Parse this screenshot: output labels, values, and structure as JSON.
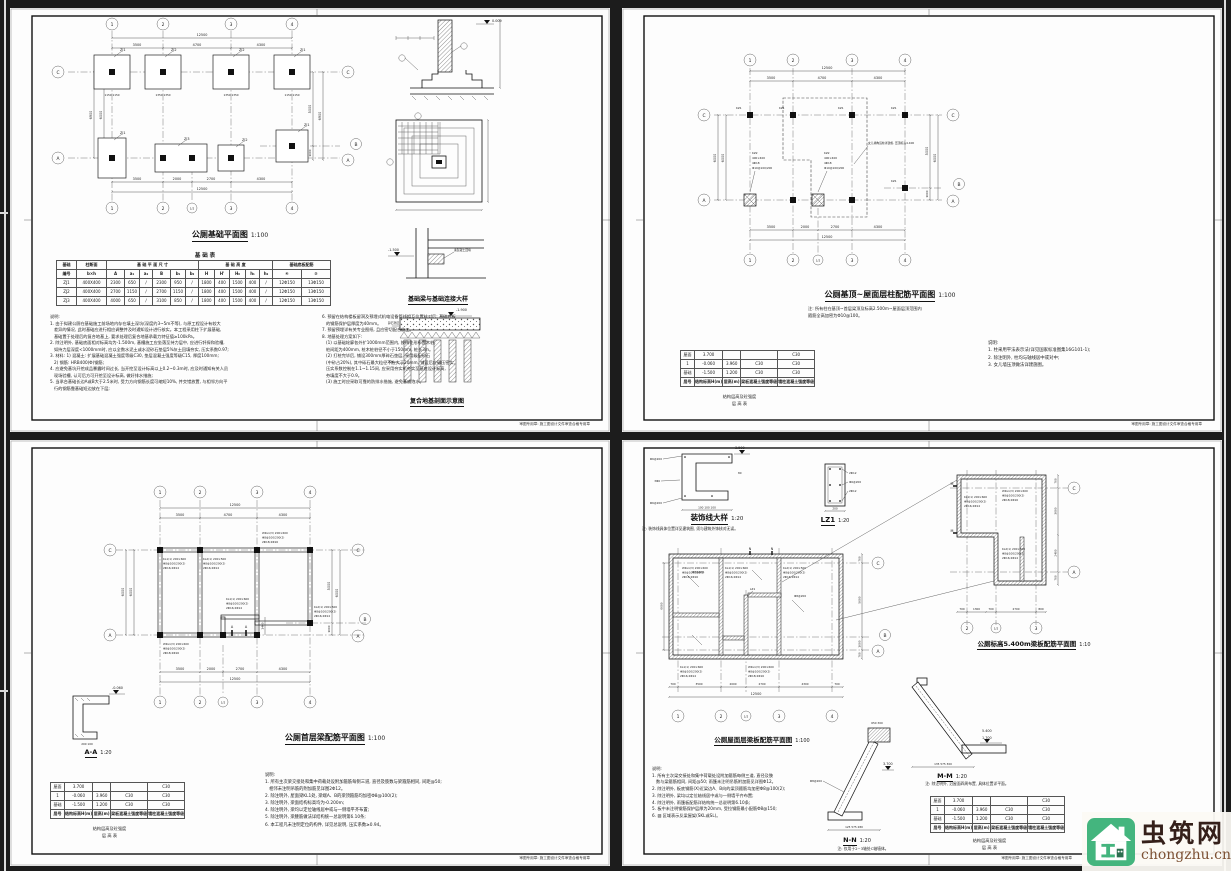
{
  "watermark": {
    "name": "虫筑网",
    "domain": "chongzhu.cn",
    "logo_green": "#44b57e",
    "logo_dark": "#2c6e4f",
    "name_color": "#35201a",
    "domain_color": "#7d5134"
  },
  "shared": {
    "footer": "审图专用章: 施工图设计文件审查合格专用章",
    "floor_table": {
      "col_widths": [
        14,
        24,
        18,
        30,
        30
      ],
      "rows": [
        [
          "屋面",
          "3.700",
          "",
          "",
          "C30"
        ],
        [
          "1",
          "-0.060",
          "3.960",
          "C30",
          "C30"
        ],
        [
          "基础",
          "-1.500",
          "1.200",
          "C30",
          "C30"
        ]
      ],
      "header": [
        "层号",
        "结构标高H(m)",
        "层高(m)",
        "梁板混凝土强度等级",
        "墙柱混凝土强度等级"
      ]
    },
    "floor_captions": [
      "结构层高及砼强度",
      "层 高 表"
    ],
    "bl_a": [
      "KL1(1) 200×600",
      "Φ8@100/200(2)",
      "2Φ16;2Φ14"
    ],
    "bl_b": [
      "WKL1(3) 200×600",
      "Φ8@100/200(2)",
      "2Φ18;2Φ16"
    ],
    "bl_c": [
      "KL2(1) 200×500",
      "Φ8@100/200(2)",
      "2Φ16;2Φ14"
    ]
  },
  "s1": {
    "title": "公厕基础平面图",
    "scale": "1:100",
    "axes_top": [
      "1",
      "2",
      "3",
      "4"
    ],
    "axes_bottom": [
      "1",
      "2",
      "1/2",
      "3",
      "4"
    ],
    "axes_left": [
      "C",
      "A"
    ],
    "axes_right": [
      "C",
      "B",
      "A"
    ],
    "dim_total": "12500",
    "dims_top": [
      "3500",
      "4700",
      "4300"
    ],
    "dims_bottom": [
      "3500",
      "2000",
      "2700",
      "4300"
    ],
    "dims_left": [
      "6900",
      "6000"
    ],
    "dims_right": [
      "5000",
      "1000",
      "6900"
    ],
    "pads_top": [
      "ZJ1",
      "ZJ2",
      "ZJ2",
      "ZJ1"
    ],
    "pads_bottom": [
      "ZJ1",
      "ZJ3",
      "ZJ2",
      "ZJ1"
    ],
    "pad_dim_a": "1150  1150",
    "pad_dim_b": "1350  1350",
    "levels": {
      "zero": "0.000",
      "base": "-1.500",
      "comp": "-1.900"
    },
    "labels": {
      "cushion": "碎石垫层",
      "pile": "木桩",
      "fill": "素混凝土回填"
    },
    "detail_title_1": "基础梁与基础连接大样",
    "detail_title_2": "复合地基剖面示意图",
    "table_title": "基 础 表",
    "table": {
      "col_widths": [
        20,
        30,
        18,
        15,
        13,
        18,
        15,
        13,
        16,
        15,
        16,
        14,
        13,
        29,
        29
      ],
      "group_headers": [
        "基础",
        "柱断面",
        "基 础 平 面 尺 寸",
        "基 础 高 度",
        "基础底板配筋"
      ],
      "group_spans": [
        1,
        1,
        6,
        5,
        2
      ],
      "sub_headers": [
        "编号",
        "b×h",
        "A",
        "a₁",
        "a₂",
        "B",
        "b₁",
        "b₂",
        "H",
        "H'",
        "H₀",
        "h₁",
        "h₂",
        "④",
        "⑤"
      ],
      "rows": [
        [
          "ZJ1",
          "400X400",
          "2300",
          "650",
          "/",
          "2300",
          "950",
          "/",
          "1800",
          "400",
          "1500",
          "400",
          "/",
          "12Φ150",
          "13Φ150"
        ],
        [
          "ZJ2",
          "400X400",
          "2700",
          "1150",
          "/",
          "2700",
          "1150",
          "/",
          "1800",
          "400",
          "1500",
          "400",
          "/",
          "12Φ150",
          "13Φ150"
        ],
        [
          "ZJ3",
          "400X400",
          "4000",
          "650",
          "/",
          "3100",
          "850",
          "/",
          "1800",
          "400",
          "1500",
          "400",
          "/",
          "12Φ150",
          "13Φ150"
        ]
      ]
    },
    "notes_left": [
      "说明:",
      "1. 由于拟建公厕在基础施工前场地内存在填土深坑(深度约3~5m不等), 与原工程设计有较大",
      "   差异的情况, 此时基础应进行相应调整并及时通知设计进行核实。本工程采用柱下扩展基础,",
      "   基础置于处理后的复合地基上, 要求处理后复合地基承载力特征值≥100kPa。",
      "2. 除注明外, 基础底面相对标高均为-1.500m, 基槽施工应坐落至持力层中, 应进行钎探和验槽,",
      "   如持力层深度<1000mm时, 应以全数水泥土或水泥砂石垫层5%灰土回填夯实, 压实系数0.97;",
      "3. 材料: 1) 混凝土: 扩展基础混凝土强度等级C30, 垫层混凝土强度等级C15, 厚度100mm;",
      "   2) 钢筋: HRB400(Φ)钢筋;",
      "4. 应避免基坑开挖成品暴露时间过长, 当开挖至设计标高以上0.2~0.3m时, 应及时通知有关人员",
      "   现场验槽, 认可后方可开挖至设计标高, 做好排水措施;",
      "5. 当承台基础长边A或B大于2.5米时, 受力方向钢筋长度可缩短10%, 并交错放置, 与相邻方向平",
      "   行的钢筋靠基础短边放在下层;"
    ],
    "notes_right": [
      "6. 预留在结构楼板留洞及预埋式机电设备管线相互位置核对后; 基础底板",
      "   的钢筋保护层厚度为40mm。",
      "7. 预留预埋详有关专业图纸, 且应密切配合施工。",
      "8. 地基处理方案如下:",
      "   (1) 以基础轮廓各外扩1000mm范围内, 按梅花形布置木桩,",
      "   桩间距为400mm, 桩木桩桩径不小于150mm, 桩长3m。",
      "   (2) 打桩完毕后, 铺设300mm厚碎石垫层, 采用级配砂石",
      "   (中砂占20%), 其中砾石最大粒径不应大于20mm, 铺设后应碾压密实,",
      "   压实系数控制在1.1~1.15间, 应采用夯实机夯实至基底设计标高,",
      "   夯填度不大于0.9。",
      "   (3) 施工时应采取可靠的防排水措施, 避免基底泡水。"
    ]
  },
  "s2": {
    "title": "公厕基顶~屋面层柱配筋平面图",
    "scale": "1:100",
    "axes_top": [
      "1",
      "2",
      "3",
      "4"
    ],
    "axes_bottom": [
      "1",
      "2",
      "1/2",
      "3",
      "4"
    ],
    "axes_left": [
      "C",
      "A"
    ],
    "axes_right": [
      "C",
      "B",
      "A"
    ],
    "dim_total": "12500",
    "dims_top": [
      "3500",
      "4700",
      "4300"
    ],
    "dims_bottom": [
      "3500",
      "2000",
      "2700",
      "4300"
    ],
    "dims_left": [
      "6000",
      "6000"
    ],
    "dims_right": [
      "5000",
      "1000",
      "6000"
    ],
    "kz1": "KZ1",
    "kz2": [
      "KZ2",
      "400×400",
      "4Φ18",
      "Φ10@100/200"
    ],
    "parapet": "女儿墙构造柱详建施, 压顶标高4.400",
    "note_lines": [
      "注: 所有柱在基顶~首层梁顶及标高2.500m~屋面层顶范围内",
      "箍筋全高加密为Φ10@100。"
    ],
    "notes": [
      "说明:",
      "1. 柱采用平法表示法(详见国家标准图集16G101-1);",
      "2. 除注明外, 柱均与轴线居中或对中;",
      "3. 女儿墙压顶做法详建施图。"
    ]
  },
  "s3": {
    "title": "公厕首层梁配筋平面图",
    "scale": "1:100",
    "axes_top": [
      "1",
      "2",
      "3",
      "4"
    ],
    "axes_bottom": [
      "1",
      "2",
      "1/2",
      "3",
      "4"
    ],
    "axes_left": [
      "C",
      "A"
    ],
    "axes_right": [
      "C",
      "B",
      "A"
    ],
    "dim_total": "12500",
    "dims_top": [
      "3500",
      "4700",
      "4300"
    ],
    "dims_bottom": [
      "3500",
      "2000",
      "2700",
      "4300"
    ],
    "dims_left": [
      "6000",
      "6000"
    ],
    "dims_right": [
      "5000",
      "1000",
      "6000"
    ],
    "dim_1400": "1400",
    "section_mark": "A",
    "aa": {
      "title": "A-A",
      "scale": "1:20",
      "level": "-0.060",
      "dims": "200  100"
    },
    "notes": [
      "说明:",
      "1. 所有主次梁交接处和集中荷载处设附加箍筋每侧三道, 直径及肢数与梁箍筋相同, 间距@50;",
      "   相邻未注明吊筋的附加筋见详图2Φ12。",
      "2. 除注明外, 屋面梁KL1处, 梁端A、B的梁顶箍筋均加密Φ8@100(2);",
      "3. 除注明外, 梁面结构标高均为-0.200m;",
      "4. 除注明外, 梁均以定位轴线居中或与一侧墙平齐布置;",
      "5. 除注明外, 梁腰筋做法详结构统一总说明第6.10条;",
      "6. 本工程凡未注明定位的构件, 详见总说明, 压实系数≥0.94。"
    ]
  },
  "s4": {
    "dec": {
      "title": "装饰线大样",
      "scale": "1:20",
      "note": "注: 装饰线具体位置详见建筑图, 须与建筑外饰核对无误。",
      "level": "3.500",
      "dims": "100 100 100",
      "side": "80",
      "bars1": "Φ6@200",
      "bars2": "3Φ6"
    },
    "lz1": {
      "title": "LZ1",
      "scale": "1:20",
      "dim": "200",
      "bars": [
        "2Φ12",
        "Φ6@200",
        "2Φ12"
      ]
    },
    "roof": {
      "title": "公厕屋面层梁板配筋平面图",
      "scale": "1:100",
      "axes_bottom": [
        "1",
        "2",
        "1/2",
        "3",
        "4"
      ],
      "axes_right": [
        "C",
        "B",
        "A"
      ],
      "dims_bottom": [
        "700",
        "3500",
        "2000",
        "2700",
        "4300",
        "700"
      ],
      "dim_total": "12500",
      "dims_right": [
        "700",
        "5000",
        "1000",
        "700"
      ],
      "dim_left": "6000",
      "slab": "Φ8@200",
      "lz1_mark": "LZ1",
      "mark_n": "N"
    },
    "el54": {
      "title": "公厕标高5.400m梁板配筋平面图",
      "scale": "1:10",
      "axes_bottom": [
        "2",
        "1/2",
        "3"
      ],
      "axes_right": [
        "C",
        "A"
      ],
      "dims_bottom": [
        "700",
        "1300",
        "700",
        "2700",
        "800"
      ],
      "dims_right": [
        "700",
        "3600",
        "2400",
        "700"
      ],
      "mark_m": "M"
    },
    "nn": {
      "title": "N-N",
      "scale": "1:20",
      "note": "注: 仅用于2~3轴处C轴墙体。",
      "level": "3.700",
      "dims": "125  575  280",
      "top_dims": "650  300",
      "bar": "Φ8@200"
    },
    "mm": {
      "title": "M-M",
      "scale": "1:20",
      "note": "注: 除注明外, 沿屋面四周布置, 具体位置详平面。",
      "levels": [
        "5.400",
        "1.700"
      ],
      "dims": "135  575  300"
    },
    "notes": [
      "说明:",
      "1. 所有主次梁交接处和集中荷载处设附加箍筋每侧三道, 直径及肢",
      "   数与梁箍筋相同, 间距@50; 雨篷未注明吊筋附加筋见详图Φ12。",
      "2. 除注明外, 板底钢筋(X)近梁边A、B向的梁顶箍筋均加密Φ8@100(2);",
      "3. 除注明外, 梁均以定位轴线居中或与一侧墙平齐布置;",
      "4. 除注明外, 雨篷板配筋详结构统一总说明第6.10条;",
      "5. 板中未注明钢筋保护层厚为20mm, 受拉钢筋最小配筋Φ8@150;",
      "6. ▨ 区域表示反梁屋架(SKL或SL)。"
    ]
  }
}
